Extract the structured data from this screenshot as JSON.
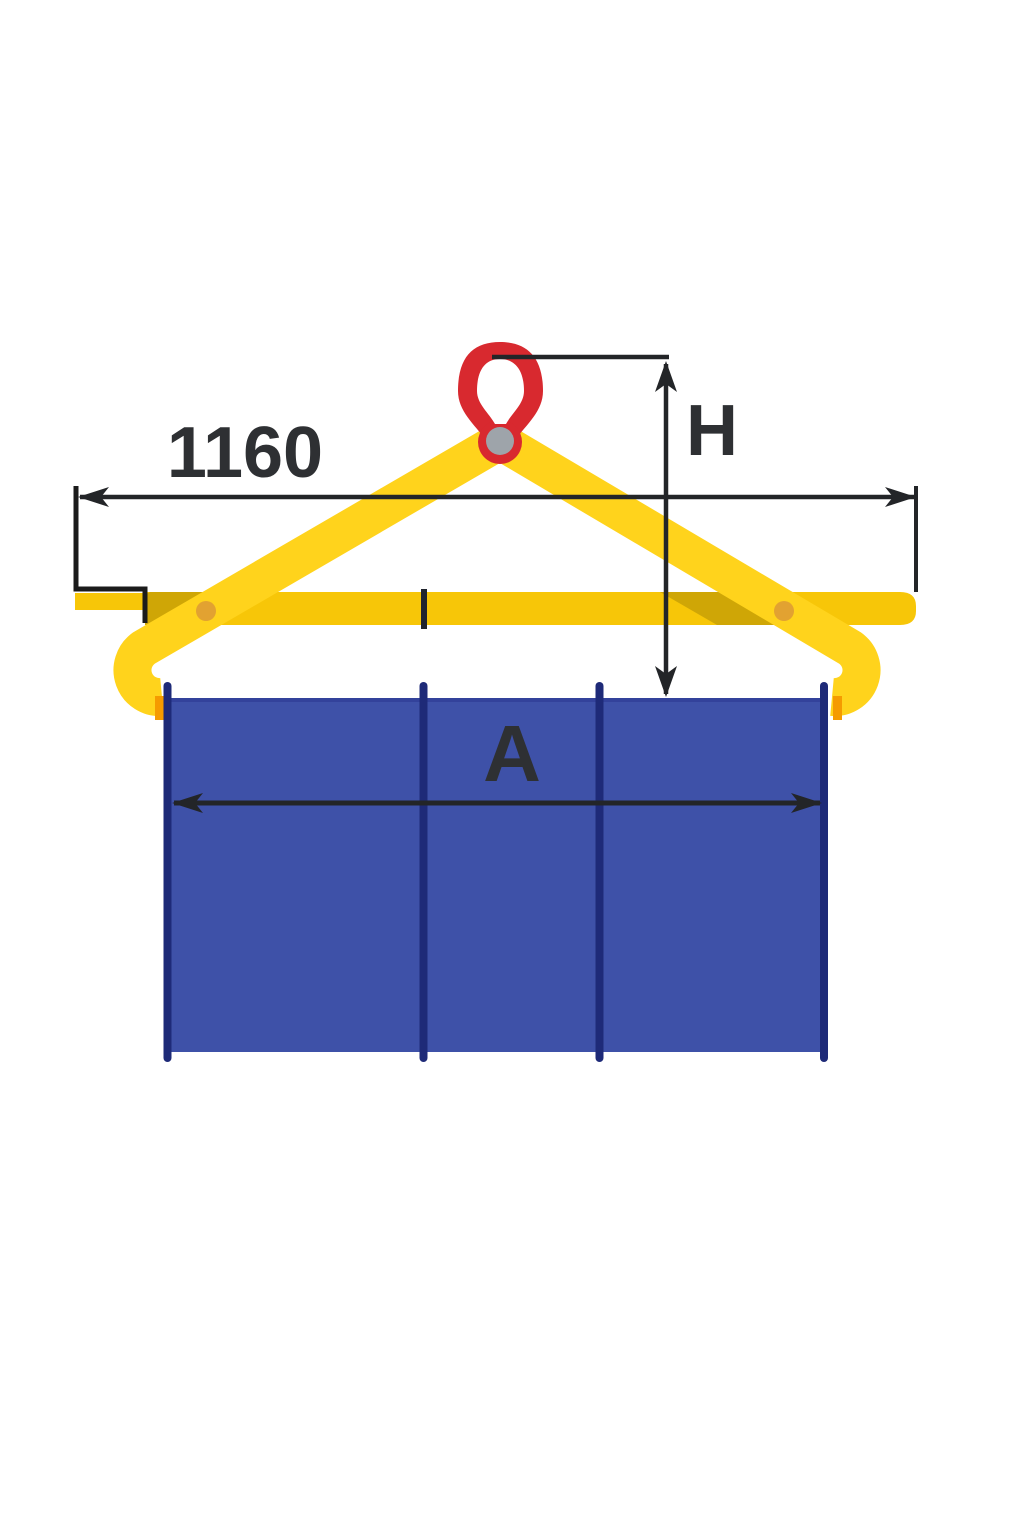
{
  "diagram": {
    "type": "technical-dimension-drawing",
    "subject": "lifting-tongs-with-block-load",
    "labels": {
      "span_dimension": "1160",
      "height_dimension": "H",
      "load_width_dimension": "A"
    },
    "colors": {
      "background": "#FFFFFF",
      "arm_yellow": "#FFD31C",
      "beam_yellow": "#F7C608",
      "hook_tip_orange": "#F59B00",
      "pivot_pin_orange": "#E2A231",
      "eye_red": "#D8292F",
      "eye_pin_gray": "#9EA4AA",
      "load_blue": "#3E51A8",
      "load_top_shade": "#33429B",
      "load_edge_blue": "#1E2A78",
      "line_dark": "#232528",
      "text_dark": "#2E3033"
    }
  }
}
